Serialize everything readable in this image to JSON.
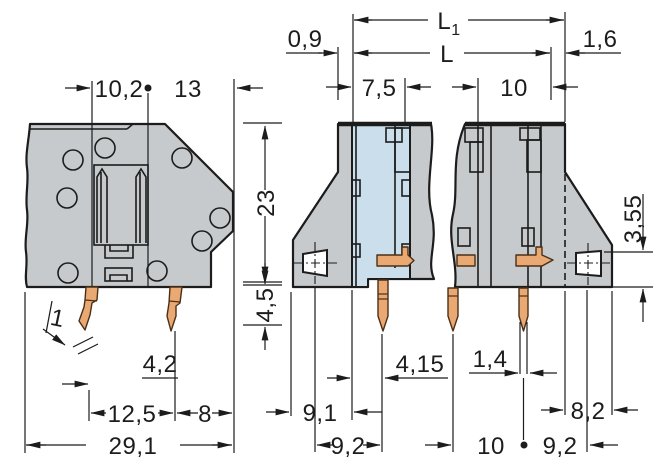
{
  "colors": {
    "housing": "#c6cacc",
    "section": "#cadfeb",
    "copper": "#eaa872",
    "line": "#1c1c1c",
    "background": "#ffffff"
  },
  "drawing": {
    "top": {
      "l1_base": "L",
      "l1_sub": "1",
      "l": "L",
      "offset_left": "0,9",
      "offset_right": "1,6",
      "pitch_small": "7,5",
      "pitch_large": "10"
    },
    "side_view": {
      "slot_offset": "10,2",
      "body_right": "13",
      "body_height": "23",
      "pin_length": "4,5",
      "pin_width": "1",
      "pin_note": "4,2",
      "pin_spacing": "12,5",
      "pin_edge": "8",
      "total_width": "29,1"
    },
    "sections": {
      "wall_left": "9,1",
      "hole_to_pin": "9,2",
      "wall_to_pin": "4,15",
      "pin_width": "1,4",
      "pin_pitch": "10",
      "pin_to_hole": "9,2",
      "hole_to_edge": "8,2",
      "hole_height": "3,55"
    }
  }
}
